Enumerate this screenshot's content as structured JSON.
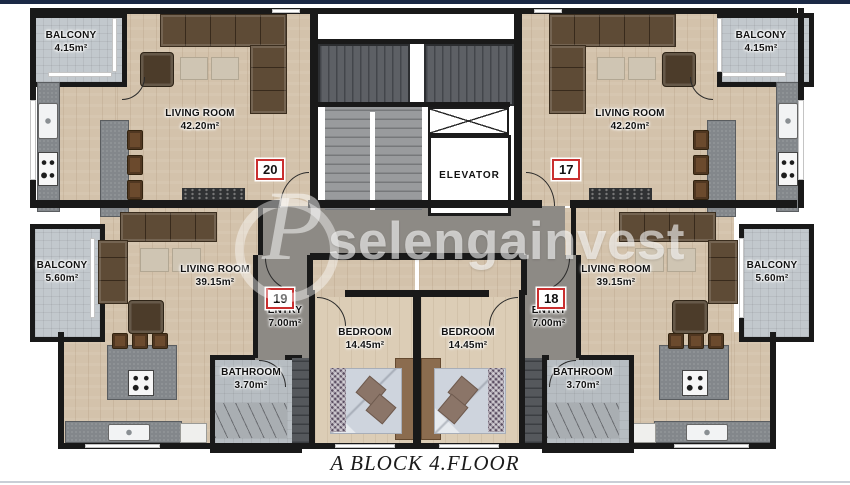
{
  "page": {
    "caption": "A BLOCK 4.FLOOR",
    "watermark": {
      "text": "selengainvest",
      "monogram": "P"
    },
    "colors": {
      "top_bar": "#1b2945",
      "bottom_rule": "#c9ced6",
      "accent_red": "#c92f2f",
      "wall": "#191919",
      "wood": "#d3c2ab",
      "corridor": "#8d8a85",
      "balcony": "#c2c8cd"
    }
  },
  "floorplan": {
    "elevator_label": "ELEVATOR",
    "units": [
      {
        "id": "20",
        "position": "top-left"
      },
      {
        "id": "17",
        "position": "top-right"
      },
      {
        "id": "19",
        "position": "bottom-left"
      },
      {
        "id": "18",
        "position": "bottom-right"
      }
    ],
    "rooms": {
      "balcony_tl": {
        "name": "BALCONY",
        "area": "4.15m²"
      },
      "balcony_tr": {
        "name": "BALCONY",
        "area": "4.15m²"
      },
      "living_tl": {
        "name": "LIVING ROOM",
        "area": "42.20m²"
      },
      "living_tr": {
        "name": "LIVING ROOM",
        "area": "42.20m²"
      },
      "balcony_ml": {
        "name": "BALCONY",
        "area": "5.60m²"
      },
      "balcony_mr": {
        "name": "BALCONY",
        "area": "5.60m²"
      },
      "living_bl": {
        "name": "LIVING ROOM",
        "area": "39.15m²"
      },
      "living_br": {
        "name": "LIVING ROOM",
        "area": "39.15m²"
      },
      "entry_l": {
        "name": "ENTRY",
        "area": "7.00m²"
      },
      "entry_r": {
        "name": "ENTRY",
        "area": "7.00m²"
      },
      "bedroom_l": {
        "name": "BEDROOM",
        "area": "14.45m²"
      },
      "bedroom_r": {
        "name": "BEDROOM",
        "area": "14.45m²"
      },
      "bathroom_l": {
        "name": "BATHROOM",
        "area": "3.70m²"
      },
      "bathroom_r": {
        "name": "BATHROOM",
        "area": "3.70m²"
      }
    }
  }
}
